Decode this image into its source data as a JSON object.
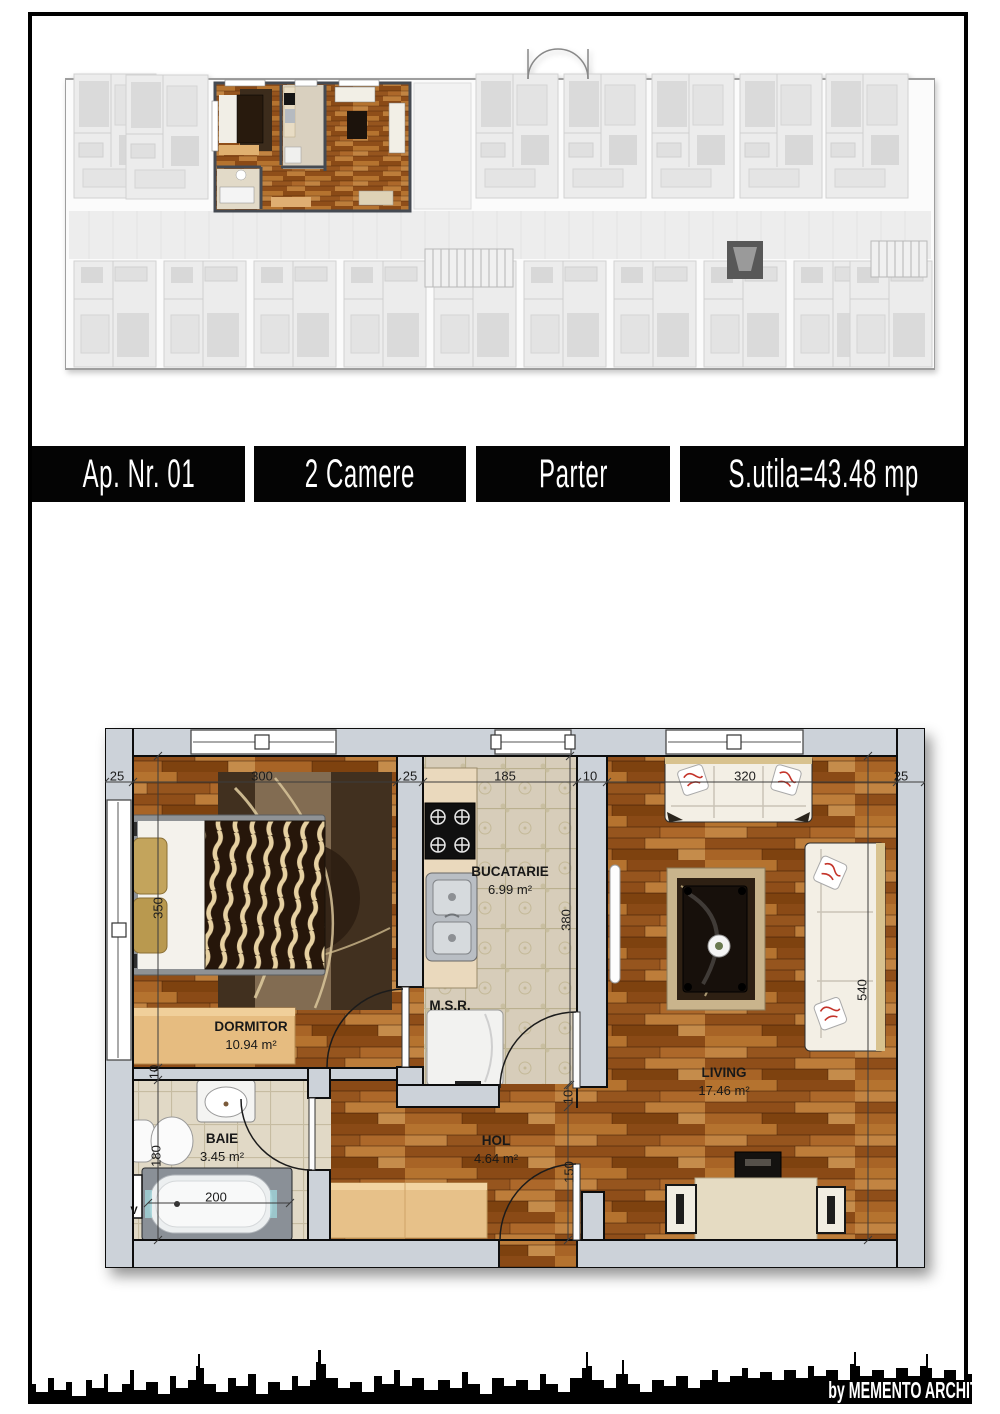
{
  "banner": {
    "items": [
      {
        "label": "Ap. Nr. 01"
      },
      {
        "label": "2 Camere"
      },
      {
        "label": "Parter"
      },
      {
        "label": "S.utila=43.48 mp"
      }
    ]
  },
  "plan": {
    "rooms": {
      "dormitor": {
        "name": "DORMITOR",
        "area": "10.94 m²"
      },
      "bucatarie": {
        "name": "BUCATARIE",
        "area": "6.99 m²"
      },
      "baie": {
        "name": "BAIE",
        "area": "3.45 m²"
      },
      "hol": {
        "name": "HOL",
        "area": "4.64 m²"
      },
      "living": {
        "name": "LIVING",
        "area": "17.46 m²"
      },
      "msr": {
        "name": "M.S.R."
      },
      "vent": {
        "name": "V"
      }
    },
    "dimensions": [
      {
        "value": "25",
        "x": 117,
        "y": 776,
        "rot": 0
      },
      {
        "value": "300",
        "x": 262,
        "y": 776,
        "rot": 0
      },
      {
        "value": "25",
        "x": 410,
        "y": 776,
        "rot": 0
      },
      {
        "value": "185",
        "x": 505,
        "y": 776,
        "rot": 0
      },
      {
        "value": "10",
        "x": 590,
        "y": 776,
        "rot": 0
      },
      {
        "value": "320",
        "x": 745,
        "y": 776,
        "rot": 0
      },
      {
        "value": "25",
        "x": 901,
        "y": 776,
        "rot": 0
      },
      {
        "value": "350",
        "x": 158,
        "y": 908,
        "rot": -90
      },
      {
        "value": "10",
        "x": 154,
        "y": 1072,
        "rot": -90
      },
      {
        "value": "180",
        "x": 156,
        "y": 1156,
        "rot": -90
      },
      {
        "value": "380",
        "x": 566,
        "y": 920,
        "rot": -90
      },
      {
        "value": "540",
        "x": 862,
        "y": 990,
        "rot": -90
      },
      {
        "value": "10",
        "x": 568,
        "y": 1097,
        "rot": -90
      },
      {
        "value": "150",
        "x": 569,
        "y": 1172,
        "rot": -90
      },
      {
        "value": "200",
        "x": 216,
        "y": 1197,
        "rot": 0
      }
    ]
  },
  "footer": {
    "credit": "by MEMENTO ARCHITECTURE"
  },
  "colors": {
    "banner_bg": "#040404",
    "banner_text": "#ffffff",
    "wood": "#9d5b20",
    "wall": "#ccd2d9",
    "kitchen_tile": "#d7cdba",
    "bath_tile": "#e1d9c6"
  }
}
